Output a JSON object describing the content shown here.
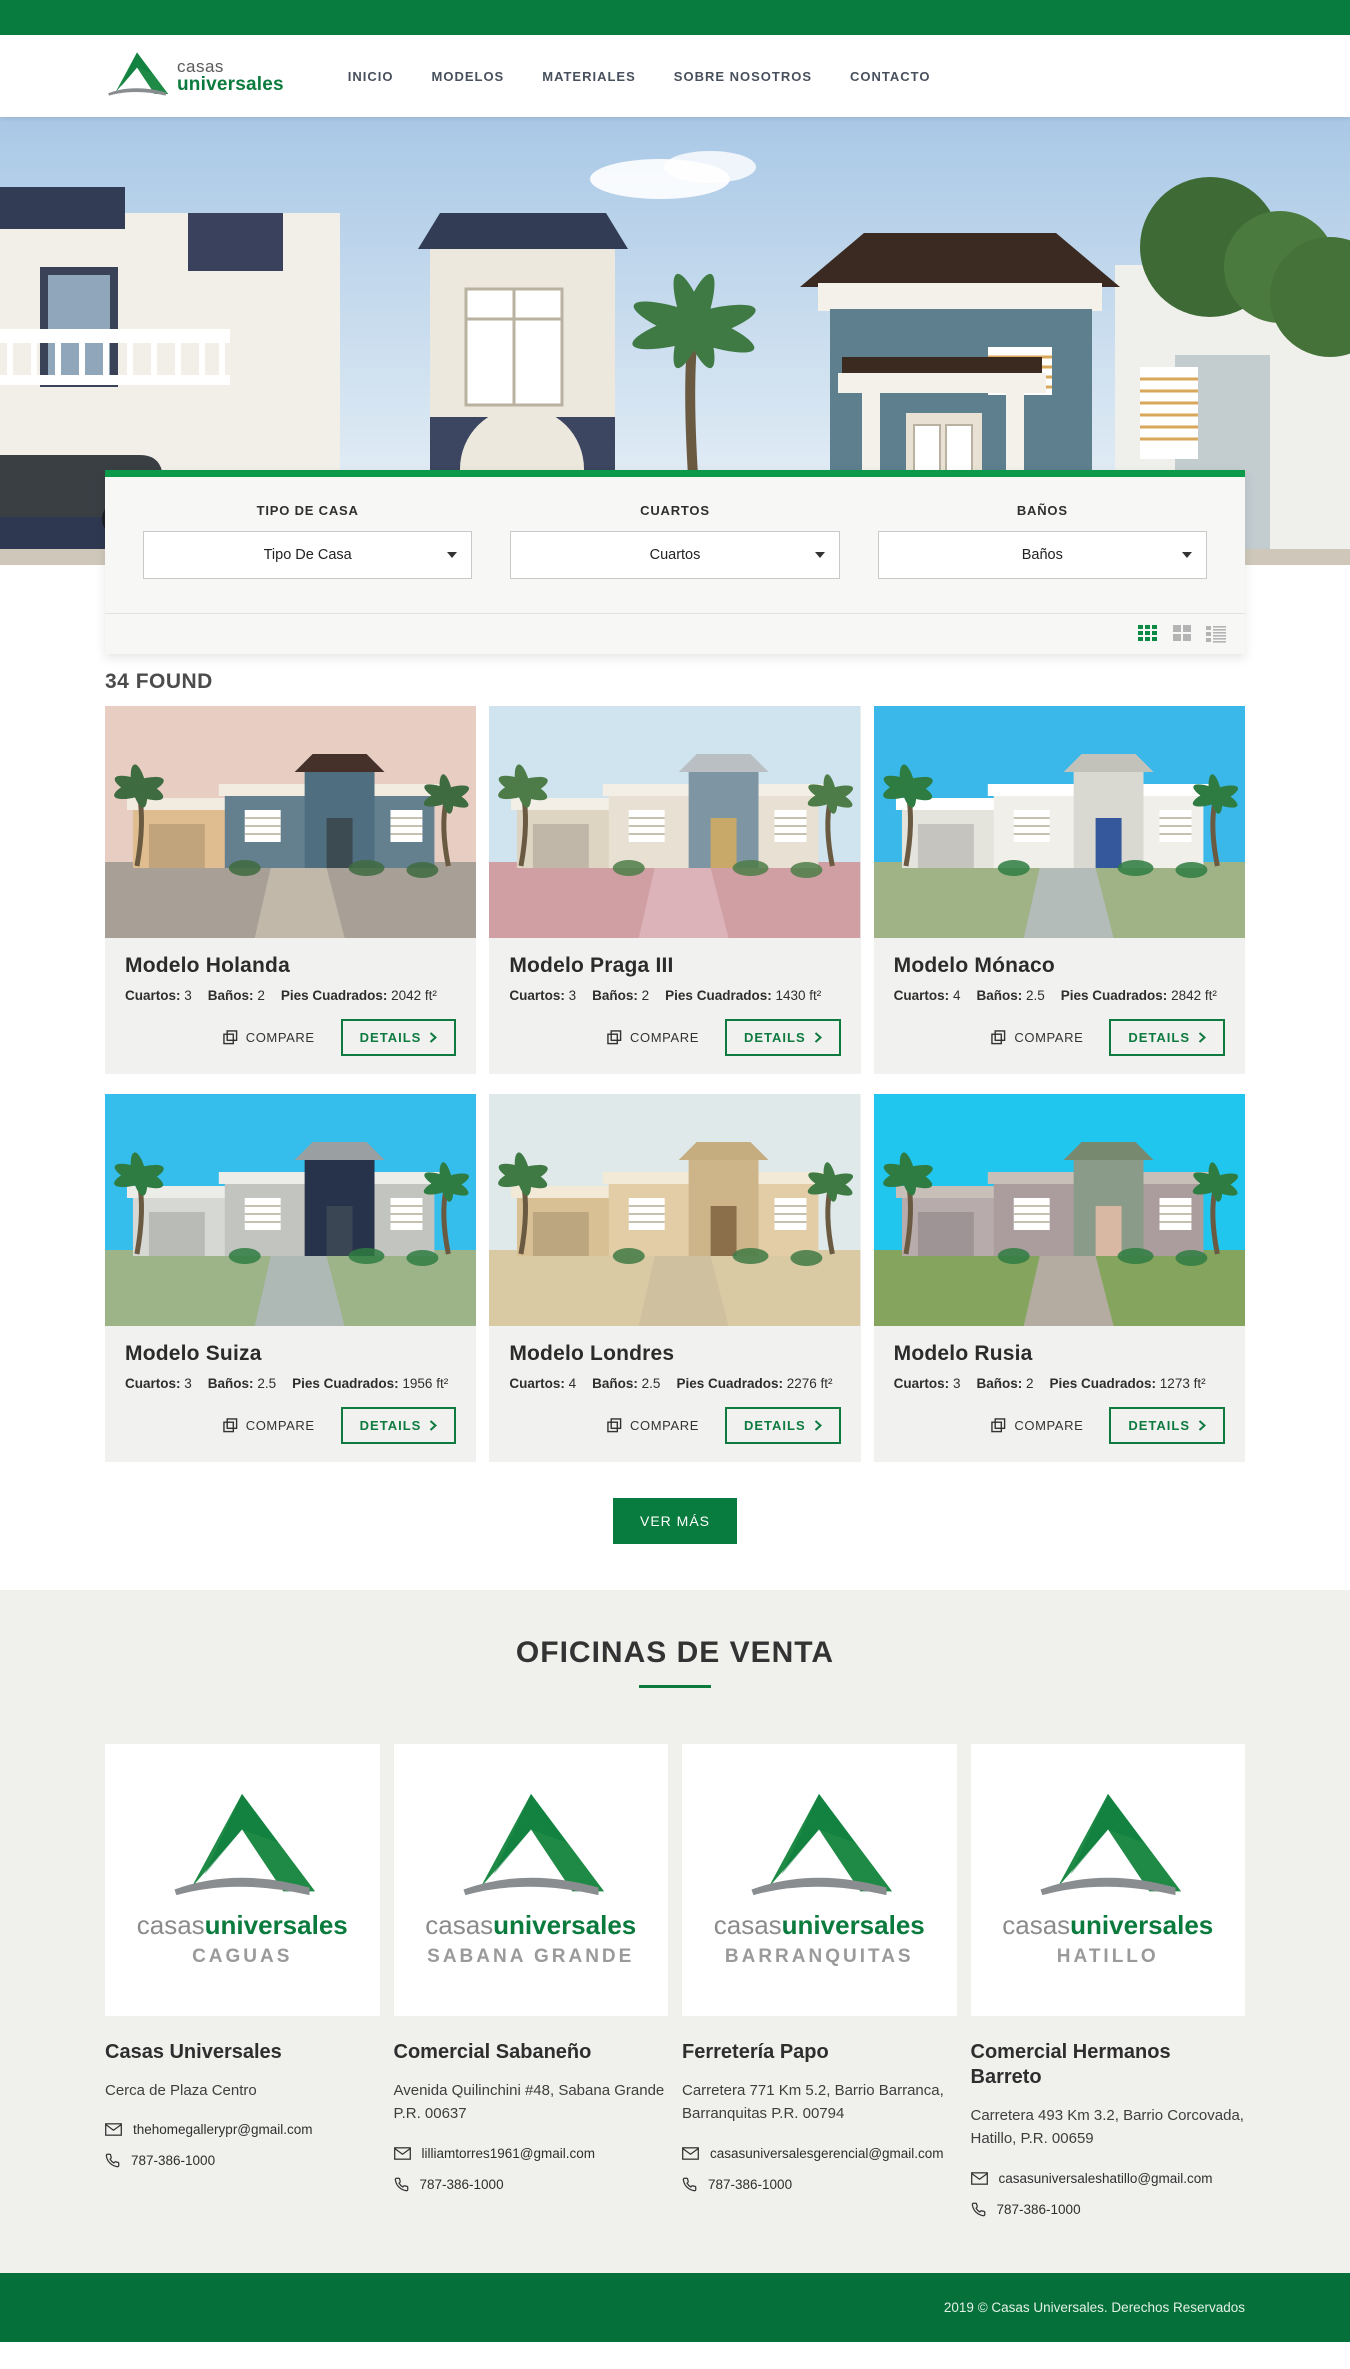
{
  "brand": {
    "logo_line1": "casas",
    "logo_line2": "universales",
    "wordmark_gray": "casas",
    "wordmark_green": "universales",
    "colors": {
      "green": "#087B3E",
      "accent_green": "#0A9A49",
      "footer_green": "#05703A",
      "details_green": "#0E7A40"
    }
  },
  "nav": {
    "items": [
      {
        "label": "INICIO"
      },
      {
        "label": "MODELOS"
      },
      {
        "label": "MATERIALES"
      },
      {
        "label": "SOBRE NOSOTROS"
      },
      {
        "label": "CONTACTO"
      }
    ]
  },
  "filters": {
    "groups": [
      {
        "label": "TIPO DE CASA",
        "value": "Tipo De Casa"
      },
      {
        "label": "CUARTOS",
        "value": "Cuartos"
      },
      {
        "label": "BAÑOS",
        "value": "Baños"
      }
    ]
  },
  "results": {
    "count_text": "34 FOUND",
    "compare_label": "COMPARE",
    "details_label": "DETAILS",
    "load_more_label": "VER MÁS"
  },
  "icons": {
    "compare": "copy-icon",
    "details": "chevron-right-icon",
    "select": "caret-down-icon",
    "views": [
      "grid-3x3-icon",
      "grid-2x2-icon",
      "list-icon"
    ],
    "email": "envelope-icon",
    "phone": "phone-icon"
  },
  "cards": [
    {
      "title": "Modelo Holanda",
      "cuartos_label": "Cuartos:",
      "cuartos_value": "3",
      "banos_label": "Baños:",
      "banos_value": "2",
      "pies_label": "Pies Cuadrados:",
      "pies_value": "2042 ft²"
    },
    {
      "title": "Modelo Praga III",
      "cuartos_label": "Cuartos:",
      "cuartos_value": "3",
      "banos_label": "Baños:",
      "banos_value": "2",
      "pies_label": "Pies Cuadrados:",
      "pies_value": "1430 ft²"
    },
    {
      "title": "Modelo Mónaco",
      "cuartos_label": "Cuartos:",
      "cuartos_value": "4",
      "banos_label": "Baños:",
      "banos_value": "2.5",
      "pies_label": "Pies Cuadrados:",
      "pies_value": "2842 ft²"
    },
    {
      "title": "Modelo Suiza",
      "cuartos_label": "Cuartos:",
      "cuartos_value": "3",
      "banos_label": "Baños:",
      "banos_value": "2.5",
      "pies_label": "Pies Cuadrados:",
      "pies_value": "1956 ft²"
    },
    {
      "title": "Modelo Londres",
      "cuartos_label": "Cuartos:",
      "cuartos_value": "4",
      "banos_label": "Baños:",
      "banos_value": "2.5",
      "pies_label": "Pies Cuadrados:",
      "pies_value": "2276 ft²"
    },
    {
      "title": "Modelo Rusia",
      "cuartos_label": "Cuartos:",
      "cuartos_value": "3",
      "banos_label": "Baños:",
      "banos_value": "2",
      "pies_label": "Pies Cuadrados:",
      "pies_value": "1273 ft²"
    }
  ],
  "offices_section": {
    "title": "OFICINAS DE VENTA",
    "offices": [
      {
        "location": "CAGUAS",
        "name": "Casas Universales",
        "address": "Cerca de Plaza Centro",
        "email": "thehomegallerypr@gmail.com",
        "phone": "787-386-1000"
      },
      {
        "location": "SABANA GRANDE",
        "name": "Comercial Sabaneño",
        "address": "Avenida Quilinchini #48, Sabana Grande P.R. 00637",
        "email": "lilliamtorres1961@gmail.com",
        "phone": "787-386-1000"
      },
      {
        "location": "BARRANQUITAS",
        "name": "Ferretería Papo",
        "address": "Carretera 771 Km 5.2, Barrio Barranca, Barranquitas P.R. 00794",
        "email": "casasuniversalesgerencial@gmail.com",
        "phone": "787-386-1000"
      },
      {
        "location": "HATILLO",
        "name": "Comercial Hermanos Barreto",
        "address": "Carretera 493 Km 3.2, Barrio Corcovada, Hatillo, P.R. 00659",
        "email": "casasuniversaleshatillo@gmail.com",
        "phone": "787-386-1000"
      }
    ]
  },
  "footer": {
    "copyright": "2019 © Casas Universales. Derechos Reservados"
  }
}
